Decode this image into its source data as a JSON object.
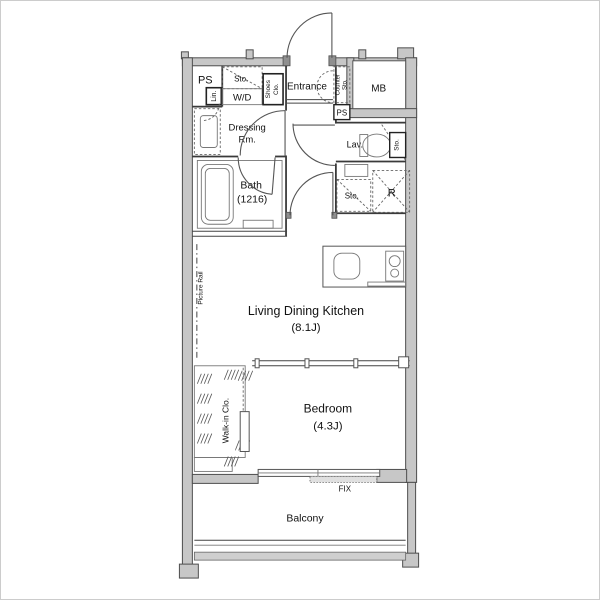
{
  "floorplan": {
    "type": "apartment-floor-plan",
    "labels": {
      "ps_left": "PS",
      "linen": "Lin.",
      "storage_above_wd": "Sto.",
      "washer_dryer": "W/D",
      "shoes_closet_l1": "Shoes",
      "shoes_closet_l2": "Clo.",
      "entrance": "Entrance",
      "counter_storage_l1": "Counter",
      "counter_storage_l2": "Sto.",
      "meter_box": "MB",
      "ps_right": "PS",
      "dressing_l1": "Dressing",
      "dressing_l2": "Rm.",
      "lavatory": "Lav.",
      "storage_lav": "Sto.",
      "storage_hall": "Sto.",
      "refrigerator": "R",
      "bath_l1": "Bath",
      "bath_l2": "(1216)",
      "picture_rail": "Picture Rail",
      "ldk_l1": "Living Dining Kitchen",
      "ldk_l2": "(8.1J)",
      "walk_in_closet": "Walk-in Clo.",
      "bedroom_l1": "Bedroom",
      "bedroom_l2": "(4.3J)",
      "fix_window": "FIX",
      "balcony": "Balcony"
    },
    "colors": {
      "wall_fill": "#c7c7c7",
      "wall_stroke": "#4d4d4d",
      "line": "#444444",
      "text": "#111111",
      "background": "#ffffff"
    }
  }
}
